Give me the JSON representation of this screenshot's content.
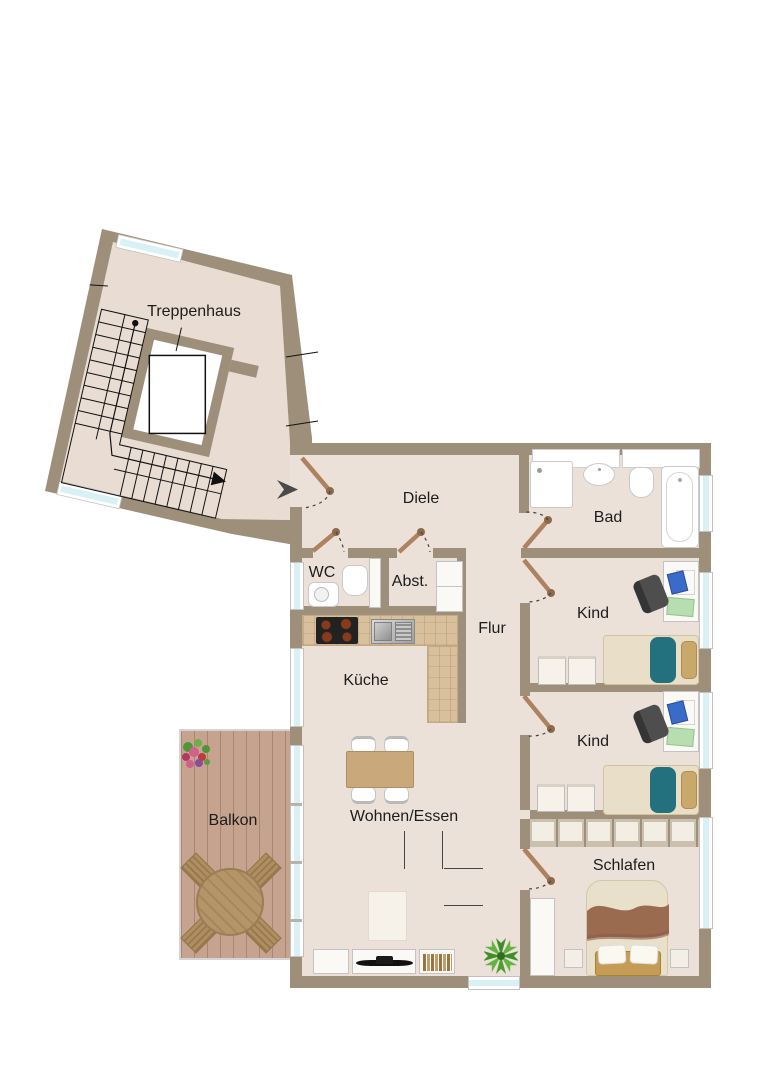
{
  "floorplan": {
    "rooms": {
      "treppenhaus": "Treppenhaus",
      "diele": "Diele",
      "bad": "Bad",
      "wc": "WC",
      "abstellraum": "Abst.",
      "flur": "Flur",
      "kind_1": "Kind",
      "kind_2": "Kind",
      "kueche": "Küche",
      "balkon": "Balkon",
      "wohnen_essen": "Wohnen/Essen",
      "schlafen": "Schlafen"
    },
    "colors": {
      "wall": "#9e8f7b",
      "floor": "#ece1d9",
      "stair_floor": "#e9ddd3",
      "window_glass": "#d9f1f4",
      "balcony_deck": "#c6a38e",
      "kitchen_counter": "#d9c09d",
      "door_leaf": "#ad825f",
      "sofa": "#565656",
      "kids_blanket": "#23707f",
      "bed_blanket": "#9b6b50",
      "wood_furniture": "#c9a97c",
      "plant": "#4e9e2f",
      "label_text": "#1c1c1c"
    },
    "icons": {
      "entrance_arrow": "right-pointing solid triangle marker at apartment entry",
      "door_swing": "brown leaf line with dashed quarter-circle arc",
      "stairs_walk_line": "black line with start dot and arrow head",
      "plant": "green starburst leaves",
      "flower_pot": "cluster of green/pink/red dots"
    },
    "furniture": {
      "treppenhaus": [
        "stairs",
        "elevator"
      ],
      "bad": [
        "shower",
        "washbasin",
        "toilet",
        "bathtub"
      ],
      "wc": [
        "washbasin",
        "toilet",
        "duct"
      ],
      "abstellraum": [
        "shelf"
      ],
      "kueche": [
        "l-counter",
        "cooktop",
        "sink"
      ],
      "kind_1": [
        "desk",
        "desk-chair",
        "laptop",
        "notepad",
        "single-bed",
        "dresser",
        "dresser"
      ],
      "kind_2": [
        "desk",
        "desk-chair",
        "laptop",
        "notepad",
        "single-bed",
        "dresser",
        "dresser"
      ],
      "schlafen": [
        "wardrobe-row",
        "double-bed",
        "bench",
        "nightstand",
        "nightstand",
        "tall-cabinet"
      ],
      "wohnen_essen": [
        "dining-table",
        "four-chairs",
        "corner-sofa",
        "rug",
        "sideboard",
        "tv",
        "books",
        "plant"
      ],
      "balkon": [
        "round-table",
        "four-chairs",
        "flower-pot"
      ]
    }
  }
}
